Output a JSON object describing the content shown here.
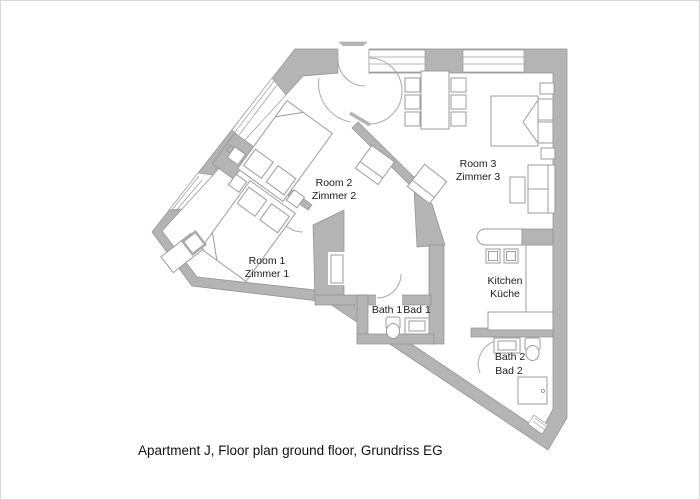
{
  "page": {
    "background": "#ffffff",
    "caption": "Apartment J, Floor plan ground floor, Grundriss EG"
  },
  "colors": {
    "wall_fill": "#b4b4b4",
    "wall_outline": "#8f8f8f",
    "furniture_line": "#9b9b9b",
    "text": "#1a1a1a"
  },
  "rooms": {
    "room1": {
      "label": "Room 1",
      "label_alt": "Zimmer 1"
    },
    "room2": {
      "label": "Room 2",
      "label_alt": "Zimmer 2"
    },
    "room3": {
      "label": "Room 3",
      "label_alt": "Zimmer 3"
    },
    "kitchen": {
      "label": "Kitchen",
      "label_alt": "Küche"
    },
    "bath1": {
      "label": "Bath 1",
      "label_alt": "Bad 1"
    },
    "bath2": {
      "label": "Bath 2",
      "label_alt": "Bad 2"
    }
  }
}
